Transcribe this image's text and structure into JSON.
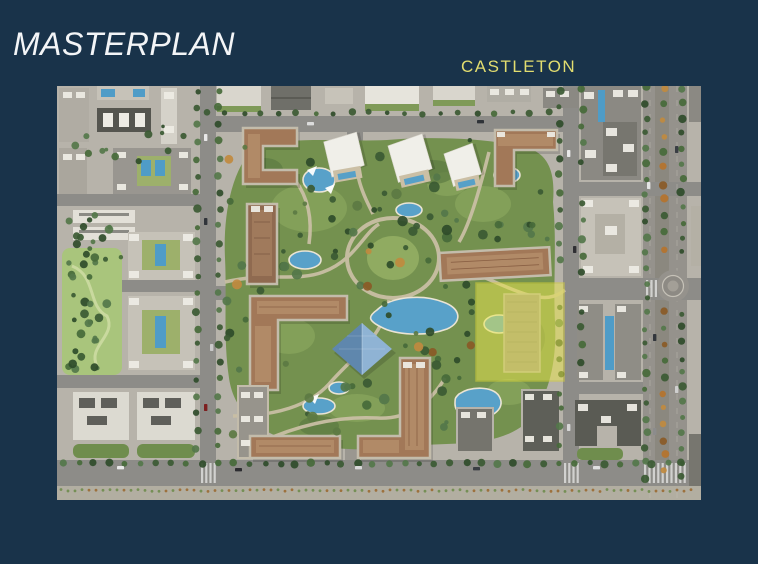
{
  "slide": {
    "title": "MASTERPLAN",
    "label": "CASTLETON",
    "colors": {
      "background": "#19334a",
      "title_text": "#f3f5f7",
      "label_text": "#e2dd6f",
      "plot_highlight": "#e9e64e"
    }
  },
  "map": {
    "type": "aerial-masterplan-render",
    "highlighted_plot_label": "CASTLETON"
  }
}
